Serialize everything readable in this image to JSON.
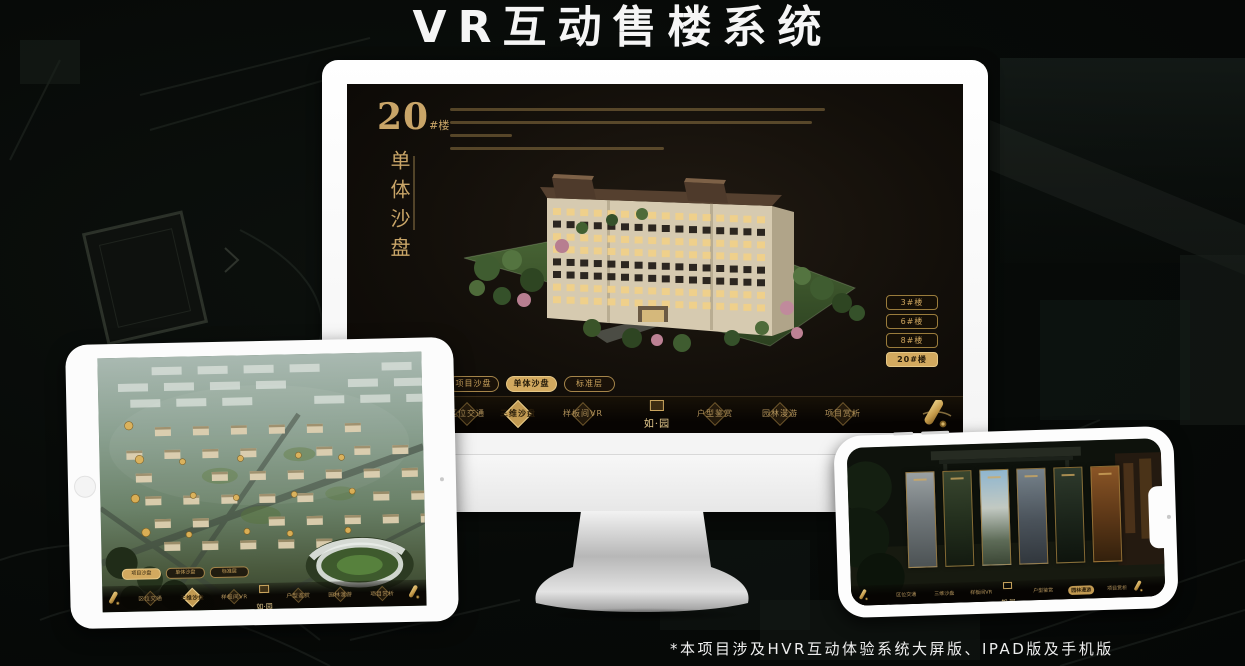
{
  "page": {
    "title": "VR互动售楼系统",
    "footnote": "*本项目涉及HVR互动体验系统大屏版、IPAD版及手机版"
  },
  "colors": {
    "gold": "#C9A063",
    "gold_active": "#D2A95F",
    "screen_bg": "#14100B",
    "nav_bg": "#0B0804",
    "active_text": "#241A09"
  },
  "desktop_screen": {
    "building_no": "20",
    "building_suffix": "#楼",
    "section_title_vertical": "单体沙盘",
    "floor_buttons": [
      {
        "label": "3#楼",
        "active": false
      },
      {
        "label": "6#楼",
        "active": false
      },
      {
        "label": "8#楼",
        "active": false
      },
      {
        "label": "20#楼",
        "active": true
      }
    ],
    "view_tabs": [
      {
        "label": "项目沙盘",
        "active": false
      },
      {
        "label": "单体沙盘",
        "active": true
      },
      {
        "label": "标准层",
        "active": false
      }
    ],
    "nav_items": [
      {
        "label": "区位交通",
        "active": false
      },
      {
        "label": "三维沙盘",
        "active": true
      },
      {
        "label": "样板间VR",
        "active": false
      },
      {
        "label": "户型鉴赏",
        "active": false
      },
      {
        "label": "园林漫游",
        "active": false
      },
      {
        "label": "项目赏析",
        "active": false
      }
    ],
    "logo_text": "如·园"
  },
  "tablet_screen": {
    "view_tabs": [
      {
        "label": "项目沙盘",
        "active": true
      },
      {
        "label": "单体沙盘",
        "active": false
      },
      {
        "label": "标准层",
        "active": false
      }
    ],
    "nav_items": [
      {
        "label": "区位交通",
        "active": false
      },
      {
        "label": "三维沙盘",
        "active": true
      },
      {
        "label": "样板间VR",
        "active": false
      },
      {
        "label": "户型鉴赏",
        "active": false
      },
      {
        "label": "园林漫游",
        "active": false
      },
      {
        "label": "项目赏析",
        "active": false
      }
    ],
    "logo_text": "如·园"
  },
  "phone_screen": {
    "gallery_panel_count": 6,
    "nav_items": [
      {
        "label": "区位交通",
        "active": false
      },
      {
        "label": "三维沙盘",
        "active": false
      },
      {
        "label": "样板间VR",
        "active": false
      },
      {
        "label": "户型鉴赏",
        "active": false
      },
      {
        "label": "园林漫游",
        "active": true
      },
      {
        "label": "项目赏析",
        "active": false
      }
    ],
    "logo_text": "如·园"
  }
}
